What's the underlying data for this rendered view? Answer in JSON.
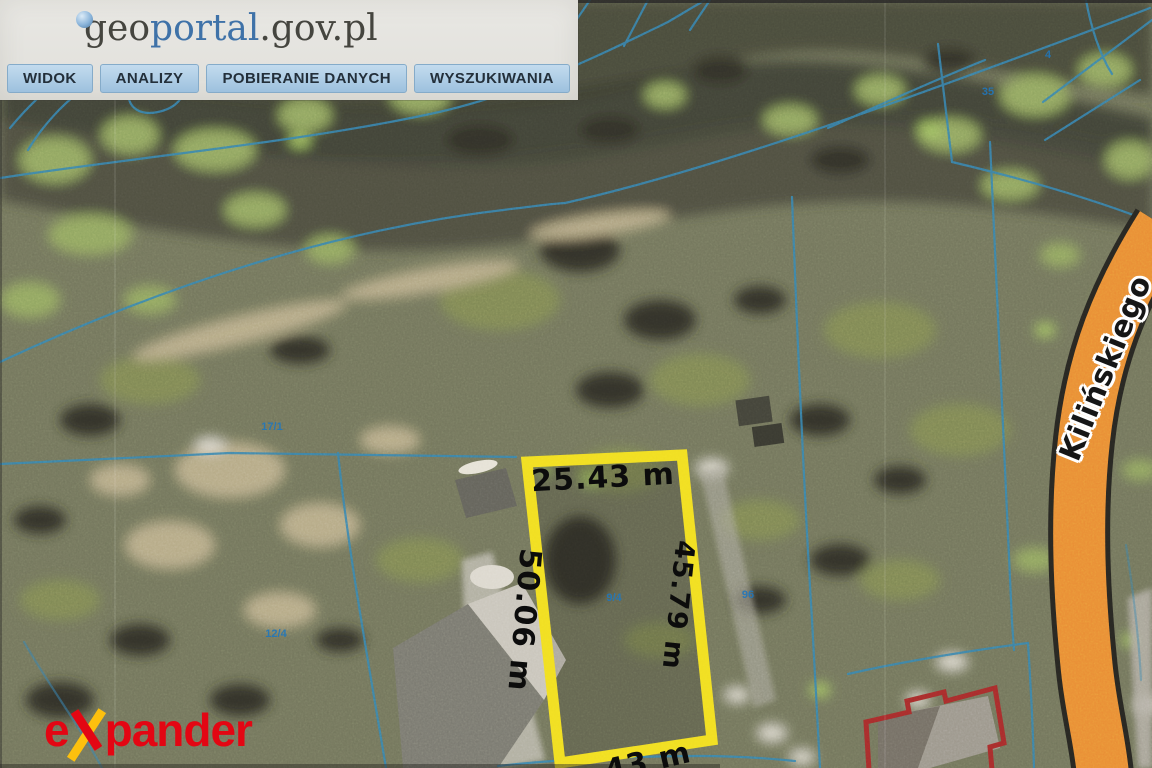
{
  "header": {
    "logo": {
      "geo": "geo",
      "portal": "portal",
      "suffix": ".gov.pl"
    },
    "menu": [
      "WIDOK",
      "ANALIZY",
      "POBIERANIE DANYCH",
      "WYSZUKIWANIA"
    ]
  },
  "map": {
    "parcel_measurements": {
      "top": "25.43 m",
      "left": "50.06 m",
      "right": "45.79 m",
      "bottom_partial": "43 m"
    },
    "street_name": "Kilińskiego",
    "cadastral_labels": [
      "17/1",
      "12/4",
      "9/4",
      "96",
      "35",
      "4"
    ],
    "colors": {
      "parcel_highlight": "#f2df1a",
      "road": "#e98a2e",
      "cadastral_line": "#2e7fae",
      "building_outline": "#a32424"
    }
  },
  "watermark": {
    "prefix": "e",
    "suffix": "pander"
  }
}
